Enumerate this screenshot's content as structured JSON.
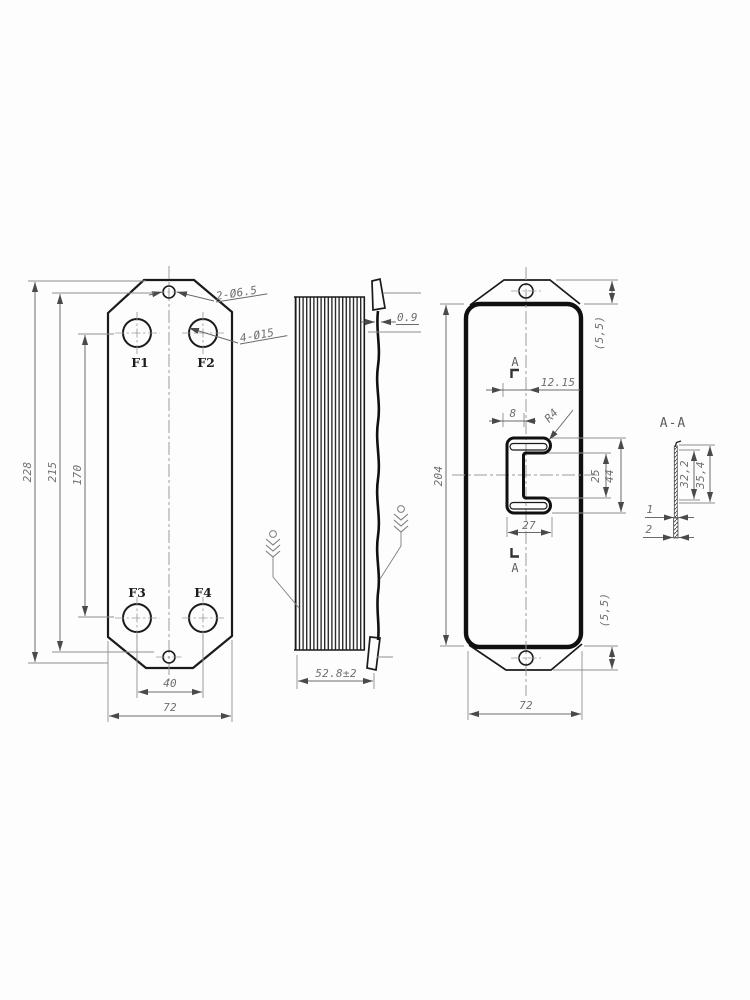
{
  "front_view": {
    "ports": [
      "F1",
      "F2",
      "F3",
      "F4"
    ],
    "callout_top_hole": "2-Ø6.5",
    "callout_ports": "4-Ø15",
    "dim_height_overall": "228",
    "dim_height_holes": "215",
    "dim_height_ports": "170",
    "dim_port_spacing": "40",
    "dim_width": "72"
  },
  "side_view": {
    "dim_plate_gap": "0.9",
    "dim_stack_depth": "52.8±2"
  },
  "back_view": {
    "dim_height": "204",
    "dim_bracket_top": "(5,5)",
    "dim_bracket_bottom": "(5,5)",
    "dim_slot_offset": "12.15",
    "dim_slot_step": "8",
    "dim_slot_radius": "R4",
    "dim_slot_inner_height": "25",
    "dim_slot_outer_height": "44",
    "dim_slot_width": "27",
    "dim_width": "72",
    "section_label_top": "A",
    "section_label_bottom": "A"
  },
  "section_view": {
    "title": "A-A",
    "dim_depth_inner": "32,2",
    "dim_depth_outer": "35,4",
    "dim_thickness_single": "1",
    "dim_thickness_double": "2"
  },
  "colors": {
    "background": "#fdfdfd",
    "part_line": "#1a1a1a",
    "dim_line": "#6a6a6a"
  }
}
